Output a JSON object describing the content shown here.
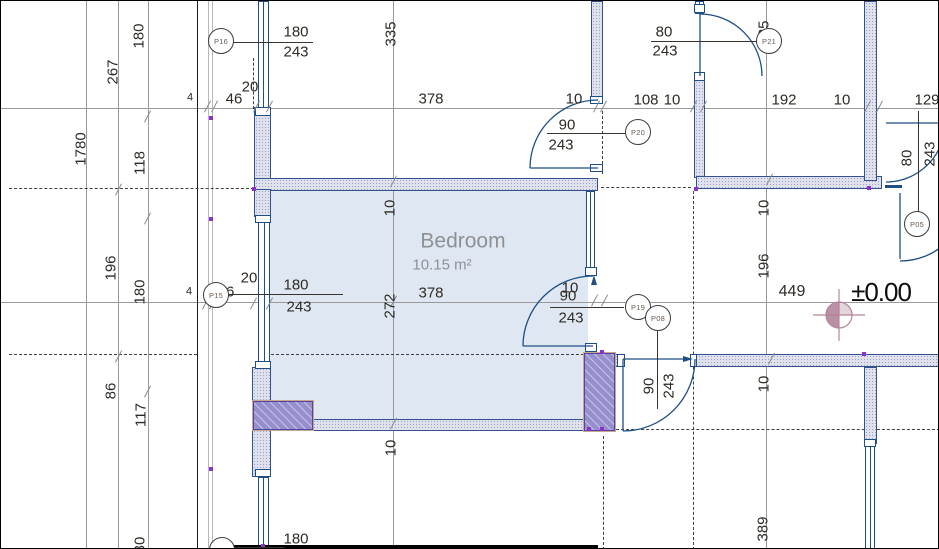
{
  "title": "Floor plan view",
  "room": {
    "name": "Bedroom",
    "area": "10.15 m²",
    "x": 462,
    "y": 240,
    "ax": 441,
    "ay": 264
  },
  "level": {
    "value": "±0.00",
    "x": 880,
    "y": 291,
    "dim": "449",
    "dx": 791,
    "dy": 291
  },
  "colors": {
    "door_blue": "#1d4f85",
    "wall_border": "#33508f",
    "wall_fill": "#e0e3ee",
    "column_purple": "#968fce",
    "survey_rose": "#b3849b",
    "room_fill": "#dce6f1",
    "dim_text": "#2e2a24"
  },
  "markers": [
    {
      "id": "P16",
      "x": 220,
      "y": 40
    },
    {
      "id": "P21",
      "x": 768,
      "y": 40
    },
    {
      "id": "P20",
      "x": 637,
      "y": 131
    },
    {
      "id": "P15",
      "x": 215,
      "y": 294
    },
    {
      "id": "P19",
      "x": 637,
      "y": 306
    },
    {
      "id": "P08",
      "x": 657,
      "y": 317
    },
    {
      "id": "P05",
      "x": 916,
      "y": 223
    },
    {
      "id": "P14",
      "x": 221,
      "y": 549
    }
  ],
  "labels": [
    {
      "t": "180",
      "x": 138,
      "y": 35,
      "r": 1
    },
    {
      "t": "267",
      "x": 112,
      "y": 71,
      "r": 1
    },
    {
      "t": "1780",
      "x": 80,
      "y": 148,
      "r": 1
    },
    {
      "t": "118",
      "x": 139,
      "y": 162,
      "r": 1
    },
    {
      "t": "196",
      "x": 110,
      "y": 267,
      "r": 1
    },
    {
      "t": "180",
      "x": 139,
      "y": 291,
      "r": 1
    },
    {
      "t": "86",
      "x": 110,
      "y": 390,
      "r": 1
    },
    {
      "t": "117",
      "x": 140,
      "y": 414,
      "r": 1
    },
    {
      "t": "30",
      "x": 139,
      "y": 544,
      "r": 1
    },
    {
      "t": "335",
      "x": 390,
      "y": 33,
      "r": 1
    },
    {
      "t": "335",
      "x": 763,
      "y": 32,
      "r": 1
    },
    {
      "t": "20",
      "x": 249,
      "y": 86
    },
    {
      "t": "46",
      "x": 233,
      "y": 98
    },
    {
      "t": "4",
      "x": 189,
      "y": 97,
      "s": 1
    },
    {
      "t": "378",
      "x": 430,
      "y": 98
    },
    {
      "t": "10",
      "x": 573,
      "y": 98
    },
    {
      "t": "108",
      "x": 645,
      "y": 99
    },
    {
      "t": "10",
      "x": 671,
      "y": 99
    },
    {
      "t": "192",
      "x": 783,
      "y": 99
    },
    {
      "t": "10",
      "x": 841,
      "y": 99
    },
    {
      "t": "129",
      "x": 926,
      "y": 99
    },
    {
      "t": "180",
      "x": 295,
      "y": 31
    },
    {
      "t": "243",
      "x": 295,
      "y": 51
    },
    {
      "t": "80",
      "x": 663,
      "y": 31
    },
    {
      "t": "243",
      "x": 664,
      "y": 50
    },
    {
      "t": "90",
      "x": 566,
      "y": 124
    },
    {
      "t": "243",
      "x": 560,
      "y": 144
    },
    {
      "t": "20",
      "x": 248,
      "y": 277
    },
    {
      "t": "46",
      "x": 225,
      "y": 291
    },
    {
      "t": "4",
      "x": 188,
      "y": 291,
      "s": 1
    },
    {
      "t": "180",
      "x": 295,
      "y": 284
    },
    {
      "t": "243",
      "x": 298,
      "y": 306
    },
    {
      "t": "378",
      "x": 430,
      "y": 292
    },
    {
      "t": "10",
      "x": 389,
      "y": 207,
      "r": 1
    },
    {
      "t": "272",
      "x": 389,
      "y": 305,
      "r": 1
    },
    {
      "t": "10",
      "x": 390,
      "y": 447,
      "r": 1
    },
    {
      "t": "10",
      "x": 569,
      "y": 287
    },
    {
      "t": "90",
      "x": 567,
      "y": 295
    },
    {
      "t": "243",
      "x": 570,
      "y": 317
    },
    {
      "t": "10",
      "x": 763,
      "y": 207,
      "r": 1
    },
    {
      "t": "196",
      "x": 763,
      "y": 265,
      "r": 1
    },
    {
      "t": "10",
      "x": 763,
      "y": 383,
      "r": 1
    },
    {
      "t": "389",
      "x": 762,
      "y": 528,
      "r": 1
    },
    {
      "t": "90",
      "x": 648,
      "y": 385,
      "r": 1
    },
    {
      "t": "243",
      "x": 668,
      "y": 385,
      "r": 1
    },
    {
      "t": "80",
      "x": 906,
      "y": 157,
      "r": 1
    },
    {
      "t": "243",
      "x": 929,
      "y": 153,
      "r": 1
    },
    {
      "t": "180",
      "x": 295,
      "y": 538
    }
  ]
}
